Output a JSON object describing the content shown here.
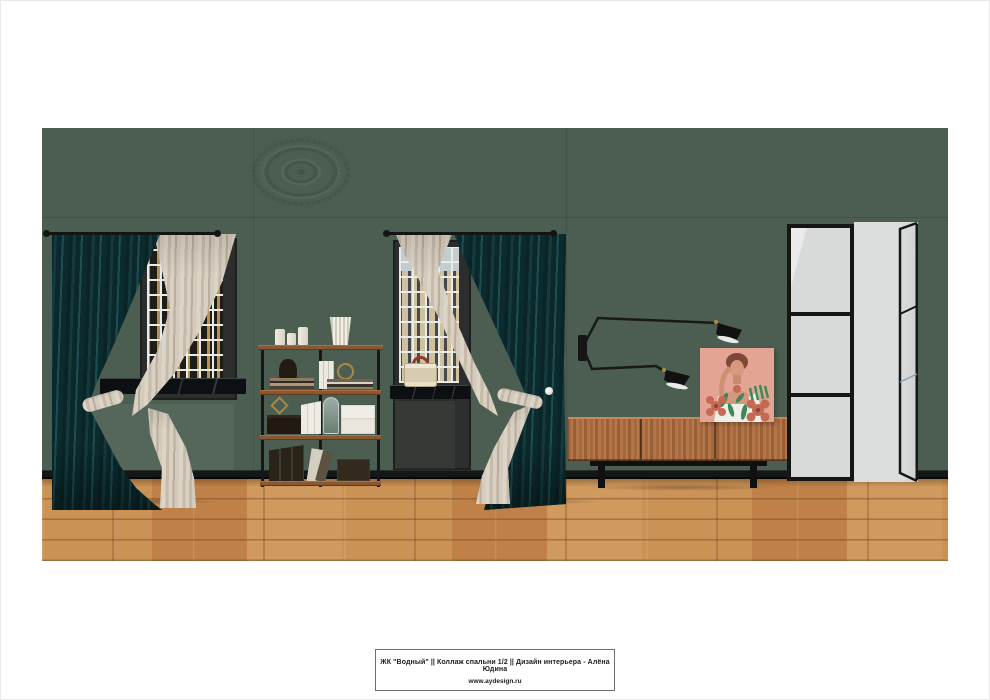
{
  "palette": {
    "wall": "#4b5e51",
    "floor": "#c38849",
    "baseboard": "#141715",
    "rod": "#141414",
    "window-frame": "#2b2e2c",
    "sill-marble": "#0d1012",
    "curtain-teal": "#0d2b2e",
    "sheer": "#d3c9bc",
    "shelf-metal": "#171717",
    "shelf-wood": "#8a5733",
    "brass": "#ab8740",
    "console-wood": "#ab6e47",
    "console-base": "#101010",
    "door-frame": "#151515",
    "door-glass": "#d8dad9",
    "door-open": "#cfd1d0",
    "lamp-black": "#141414",
    "art-pink": "#e3a494",
    "art-green": "#3e8a58",
    "art-terracotta": "#c46a52"
  },
  "title_block": {
    "line1": "ЖК \"Водный\"  ||  Коллаж спальни  1/2  ||  Дизайн интерьера  -  Алёна Юдина",
    "line2": "www.aydesign.ru"
  }
}
